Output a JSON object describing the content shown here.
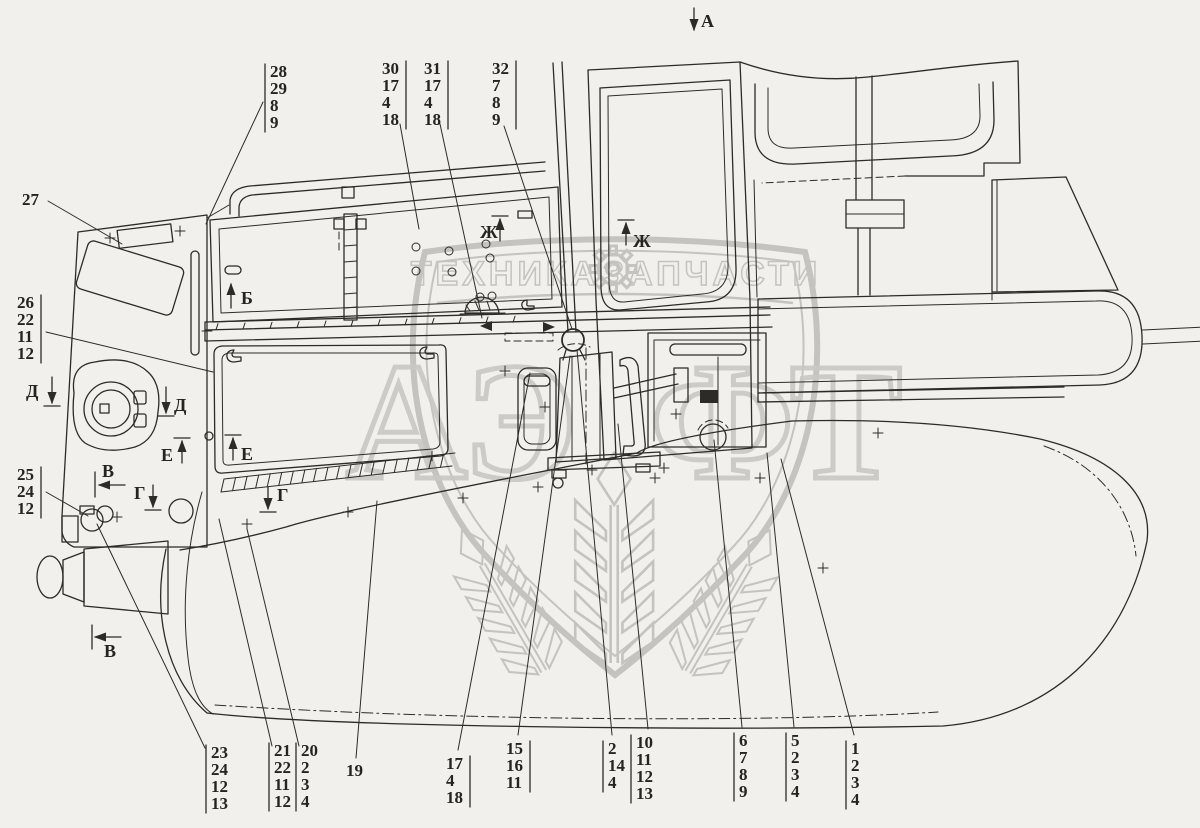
{
  "title": "Tractor cab and hood panels parts diagram",
  "colors": {
    "background": "#f1f0ec",
    "ink": "#2c2b27",
    "watermark": "#c4c3bf"
  },
  "watermark": {
    "band_left": "ТЕХНИКА",
    "band_right": "ЗАПЧАСТИ",
    "gear_icon": "gear",
    "letters_left": "АЭ",
    "letters_right": "ФТ"
  },
  "view_labels": [
    {
      "letter": "А",
      "lx": 701,
      "ly": 27,
      "arrow": [
        694,
        8,
        694,
        30
      ],
      "bar": null
    },
    {
      "letter": "Б",
      "lx": 241,
      "ly": 304,
      "arrow": [
        231,
        308,
        231,
        284
      ],
      "bar": null
    },
    {
      "letter": "Ж",
      "lx": 480,
      "ly": 238,
      "arrow": [
        500,
        241,
        500,
        219
      ],
      "bar": [
        492,
        216,
        508,
        216
      ]
    },
    {
      "letter": "Ж",
      "lx": 633,
      "ly": 247,
      "arrow": [
        626,
        245,
        626,
        223
      ],
      "bar": [
        618,
        220,
        634,
        220
      ]
    },
    {
      "letter": "Д",
      "lx": 26,
      "ly": 397,
      "arrow": [
        52,
        377,
        52,
        403
      ],
      "bar": [
        44,
        406,
        60,
        406
      ]
    },
    {
      "letter": "Д",
      "lx": 174,
      "ly": 411,
      "arrow": [
        166,
        387,
        166,
        413
      ],
      "bar": [
        158,
        416,
        174,
        416
      ]
    },
    {
      "letter": "Е",
      "lx": 161,
      "ly": 461,
      "arrow": [
        182,
        463,
        182,
        441
      ],
      "bar": [
        174,
        438,
        190,
        438
      ]
    },
    {
      "letter": "Е",
      "lx": 241,
      "ly": 460,
      "arrow": [
        233,
        460,
        233,
        438
      ],
      "bar": [
        225,
        435,
        241,
        435
      ]
    },
    {
      "letter": "В",
      "lx": 102,
      "ly": 477,
      "arrow": [
        125,
        485,
        99,
        485
      ],
      "bar": [
        95,
        472,
        95,
        497
      ]
    },
    {
      "letter": "В",
      "lx": 104,
      "ly": 657,
      "arrow": [
        121,
        637,
        95,
        637
      ],
      "bar": [
        92,
        625,
        92,
        649
      ]
    },
    {
      "letter": "Г",
      "lx": 134,
      "ly": 499,
      "arrow": [
        153,
        485,
        153,
        507
      ],
      "bar": [
        145,
        510,
        161,
        510
      ]
    },
    {
      "letter": "Г",
      "lx": 277,
      "ly": 501,
      "arrow": [
        268,
        487,
        268,
        509
      ],
      "bar": [
        260,
        512,
        276,
        512
      ]
    }
  ],
  "callouts": [
    {
      "id": "27",
      "numbers": [
        "27"
      ],
      "x": 22,
      "y": 205,
      "bar": "none",
      "leader": [
        48,
        201,
        122,
        244
      ]
    },
    {
      "id": "26-22-11-12",
      "numbers": [
        "26",
        "22",
        "11",
        "12"
      ],
      "x": 17,
      "y": 308,
      "bar": "right",
      "leader": [
        46,
        332,
        213,
        372
      ]
    },
    {
      "id": "25-24-12",
      "numbers": [
        "25",
        "24",
        "12"
      ],
      "x": 17,
      "y": 480,
      "bar": "right",
      "leader": [
        46,
        492,
        88,
        516
      ]
    },
    {
      "id": "28-29-8-9",
      "numbers": [
        "28",
        "29",
        "8",
        "9"
      ],
      "x": 270,
      "y": 77,
      "bar": "left",
      "leader": [
        263,
        102,
        206,
        224
      ]
    },
    {
      "id": "30-17-4-18",
      "numbers": [
        "30",
        "17",
        "4",
        "18"
      ],
      "x": 382,
      "y": 74,
      "bar": "right",
      "leader": [
        400,
        124,
        419,
        229
      ]
    },
    {
      "id": "31-17-4-18",
      "numbers": [
        "31",
        "17",
        "4",
        "18"
      ],
      "x": 424,
      "y": 74,
      "bar": "right",
      "leader": [
        440,
        124,
        482,
        318
      ]
    },
    {
      "id": "32-7-8-9",
      "numbers": [
        "32",
        "7",
        "8",
        "9"
      ],
      "x": 492,
      "y": 74,
      "bar": "right",
      "leader": [
        504,
        126,
        572,
        329
      ]
    },
    {
      "id": "23-24-12-13",
      "numbers": [
        "23",
        "24",
        "12",
        "13"
      ],
      "x": 211,
      "y": 758,
      "bar": "left",
      "leader": [
        205,
        748,
        97,
        524
      ]
    },
    {
      "id": "21-22-11-12",
      "numbers": [
        "21",
        "22",
        "11",
        "12"
      ],
      "x": 274,
      "y": 756,
      "bar": "left",
      "leader": [
        272,
        746,
        219,
        519
      ]
    },
    {
      "id": "20-2-3-4",
      "numbers": [
        "20",
        "2",
        "3",
        "4"
      ],
      "x": 301,
      "y": 756,
      "bar": "left",
      "leader": [
        299,
        746,
        247,
        529
      ]
    },
    {
      "id": "19",
      "numbers": [
        "19"
      ],
      "x": 346,
      "y": 776,
      "bar": "none",
      "leader": [
        356,
        758,
        377,
        501
      ]
    },
    {
      "id": "17-4-18",
      "numbers": [
        "17",
        "4",
        "18"
      ],
      "x": 446,
      "y": 769,
      "bar": "right",
      "leader": [
        458,
        750,
        530,
        373
      ]
    },
    {
      "id": "15-16-11",
      "numbers": [
        "15",
        "16",
        "11"
      ],
      "x": 506,
      "y": 754,
      "bar": "right",
      "leader": [
        518,
        735,
        570,
        356
      ]
    },
    {
      "id": "2-14-4",
      "numbers": [
        "2",
        "14",
        "4"
      ],
      "x": 608,
      "y": 754,
      "bar": "left",
      "leader": [
        612,
        735,
        577,
        350
      ]
    },
    {
      "id": "10-11-12-13",
      "numbers": [
        "10",
        "11",
        "12",
        "13"
      ],
      "x": 636,
      "y": 748,
      "bar": "left",
      "leader": [
        648,
        729,
        618,
        424
      ]
    },
    {
      "id": "6-7-8-9",
      "numbers": [
        "6",
        "7",
        "8",
        "9"
      ],
      "x": 739,
      "y": 746,
      "bar": "left",
      "leader": [
        742,
        727,
        714,
        440
      ]
    },
    {
      "id": "5-2-3-4",
      "numbers": [
        "5",
        "2",
        "3",
        "4"
      ],
      "x": 791,
      "y": 746,
      "bar": "left",
      "leader": [
        794,
        727,
        767,
        453
      ]
    },
    {
      "id": "1-2-3-4",
      "numbers": [
        "1",
        "2",
        "3",
        "4"
      ],
      "x": 851,
      "y": 754,
      "bar": "left",
      "leader": [
        854,
        735,
        781,
        459
      ]
    }
  ]
}
